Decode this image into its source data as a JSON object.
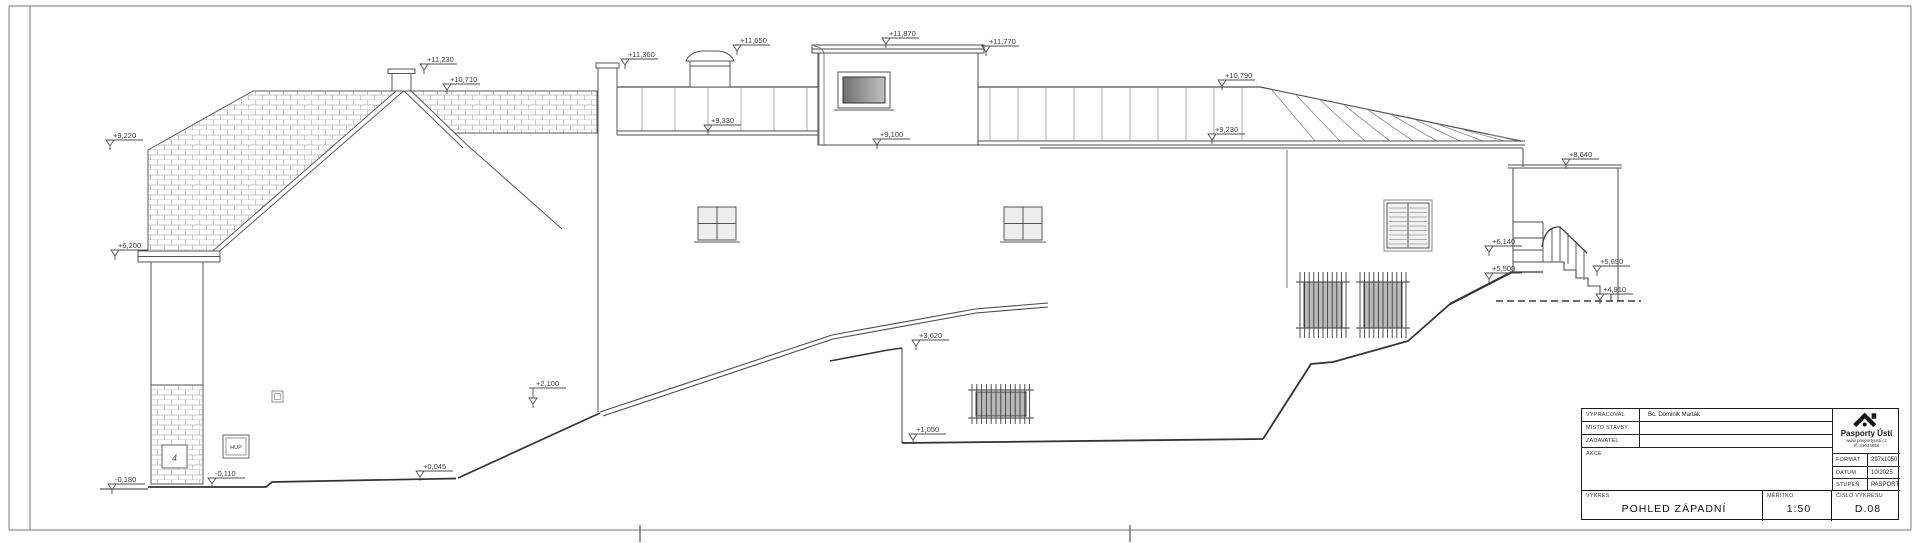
{
  "sheet": {
    "background": "#ffffff",
    "line_color": "#4d4d4d",
    "heavy_line_color": "#2e2e2e",
    "brick_line_color": "#b3b3b3"
  },
  "drawing": {
    "title": "POHLED ZÁPADNÍ",
    "annotations": {
      "hup_box": "HUP",
      "house_number": "4"
    },
    "elevation_markers": [
      {
        "label": "+9,220",
        "x": 110,
        "y": 146
      },
      {
        "label": "+6,200",
        "x": 115,
        "y": 256
      },
      {
        "label": "-0,180",
        "x": 112,
        "y": 490
      },
      {
        "label": "-0,110",
        "x": 212,
        "y": 484
      },
      {
        "label": "+11,230",
        "x": 424,
        "y": 70
      },
      {
        "label": "+10,710",
        "x": 447,
        "y": 90
      },
      {
        "label": "+11,360",
        "x": 625,
        "y": 65
      },
      {
        "label": "+9,330",
        "x": 708,
        "y": 131
      },
      {
        "label": "+11,650",
        "x": 737,
        "y": 51
      },
      {
        "label": "+11,870",
        "x": 886,
        "y": 44
      },
      {
        "label": "+9,100",
        "x": 877,
        "y": 145
      },
      {
        "label": "+11,770",
        "x": 986,
        "y": 52
      },
      {
        "label": "+10,790",
        "x": 1222,
        "y": 86
      },
      {
        "label": "+9,230",
        "x": 1212,
        "y": 140
      },
      {
        "label": "+8,640",
        "x": 1566,
        "y": 165
      },
      {
        "label": "+6,140",
        "x": 1489,
        "y": 252
      },
      {
        "label": "+5,500",
        "x": 1489,
        "y": 279
      },
      {
        "label": "+5,690",
        "x": 1597,
        "y": 272
      },
      {
        "label": "+4,910",
        "x": 1600,
        "y": 300
      },
      {
        "label": "+3,620",
        "x": 916,
        "y": 346
      },
      {
        "label": "+1,050",
        "x": 913,
        "y": 440
      },
      {
        "label": "+2,100",
        "x": 533,
        "y": 404,
        "drop": 10
      },
      {
        "label": "+0,045",
        "x": 420,
        "y": 477
      }
    ]
  },
  "title_block": {
    "rows": [
      {
        "label": "VYPRACOVAL",
        "value": "Bc. Dominik Marták"
      },
      {
        "label": "MÍSTO STAVBY",
        "value": ""
      },
      {
        "label": "ZADAVATEL",
        "value": ""
      },
      {
        "label": "AKCE",
        "value": ""
      }
    ],
    "vykres_label": "VÝKRES",
    "drawing_title": "POHLED ZÁPADNÍ",
    "meritko_label": "MĚŘÍTKO",
    "scale": "1:50",
    "cislo_vykresu_label": "ČÍSLO VÝKRESU",
    "drawing_number": "D.08",
    "format_label": "FORMÁT",
    "format_value": "297x1050",
    "datum_label": "DATUM",
    "datum_value": "10/2025",
    "stupen_label": "STUPEŇ",
    "stupen_value": "PASPORT",
    "logo": {
      "name": "Pasporty Ústí",
      "website": "www.pasportyusti.cz",
      "ico": "IČ:21634856"
    }
  }
}
